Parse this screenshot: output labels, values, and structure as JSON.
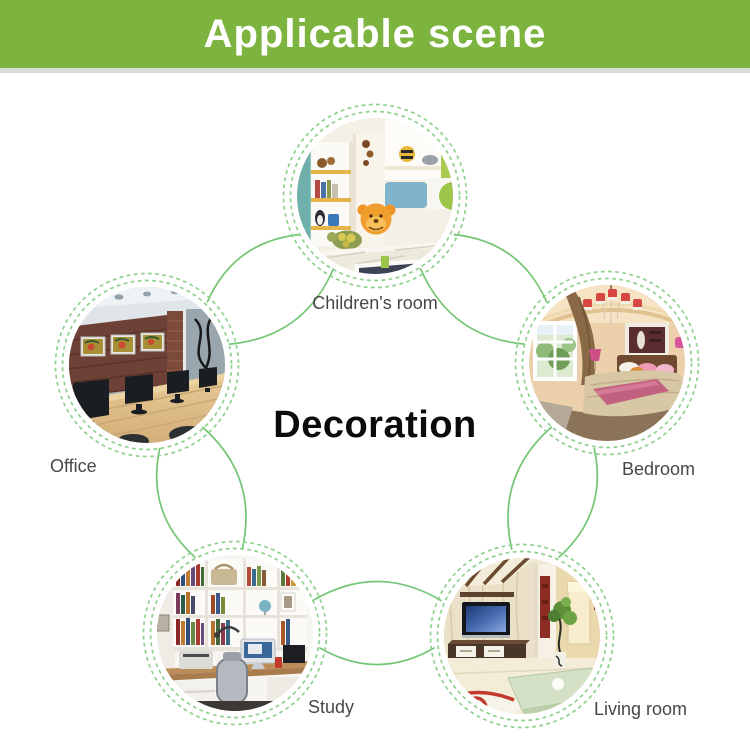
{
  "banner": {
    "title": "Applicable scene",
    "background_color": "#7db440",
    "text_color": "#ffffff"
  },
  "center_label": "Decoration",
  "scenes": [
    {
      "id": "children-room",
      "label": "Children's room",
      "position": "top"
    },
    {
      "id": "bedroom",
      "label": "Bedroom",
      "position": "right"
    },
    {
      "id": "living-room",
      "label": "Living room",
      "position": "bottom-right"
    },
    {
      "id": "study",
      "label": "Study",
      "position": "bottom-left"
    },
    {
      "id": "office",
      "label": "Office",
      "position": "left"
    }
  ],
  "colors": {
    "connector_line_green": "#74c674",
    "dashed_ring_green": "#8dd18d",
    "label_text": "#474747"
  }
}
